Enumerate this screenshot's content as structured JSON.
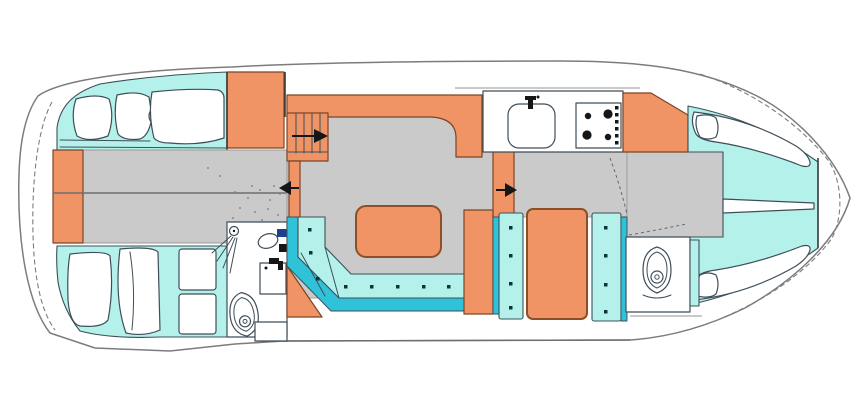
{
  "document": {
    "type": "boat-floor-plan",
    "view": "top-down interior deck plan of a motor yacht, bow pointing right",
    "visible_text": []
  },
  "colors": {
    "background": "#ffffff",
    "hull_outline": "#7c7c7c",
    "sketch_line": "#3e4e58",
    "joinery_orange": "#f09466",
    "joinery_line": "#7d4423",
    "table_line": "#8d4f26",
    "upholstery_cyan": "#b4f1eb",
    "trim_cyan_dark": "#2fc2d8",
    "floor_gray": "#cacaca",
    "floor_edge": "#9a9a9a",
    "floor_line_dark": "#6e6e6e",
    "fixture_navy": "#1d3f90",
    "ink": "#161616",
    "button_dot": "#0e3340"
  },
  "rooms": [
    {
      "id": "aft-cabin",
      "name": "Aft cabin with two double berths and wardrobe"
    },
    {
      "id": "aft-head",
      "name": "Aft bathroom with shower, washbasin and toilet"
    },
    {
      "id": "salon",
      "name": "Salon with L-shaped settee and table"
    },
    {
      "id": "galley",
      "name": "Galley with sink and four-burner stove"
    },
    {
      "id": "mid-seating",
      "name": "Mid cabin with facing settees and cabinet"
    },
    {
      "id": "bow-cabin",
      "name": "Bow cabin with V-berth"
    },
    {
      "id": "bow-head",
      "name": "Bow bathroom with toilet"
    }
  ],
  "fixtures": [
    "shower-head",
    "washbasin",
    "mixer-tap",
    "toilet-aft",
    "toilet-bow",
    "galley-sink",
    "stove-four-burners",
    "stove-knobs",
    "settee-buttons",
    "companionway-stairs",
    "dining-table"
  ],
  "counts": {
    "stove_burners": 4,
    "stove_knobs": 6,
    "toilets": 2,
    "arrows": 3
  },
  "arrows": [
    {
      "id": "companionway-steps",
      "direction": "right"
    },
    {
      "id": "aft-cabin-entry",
      "direction": "left"
    },
    {
      "id": "bow-cabin-entry",
      "direction": "right"
    }
  ]
}
